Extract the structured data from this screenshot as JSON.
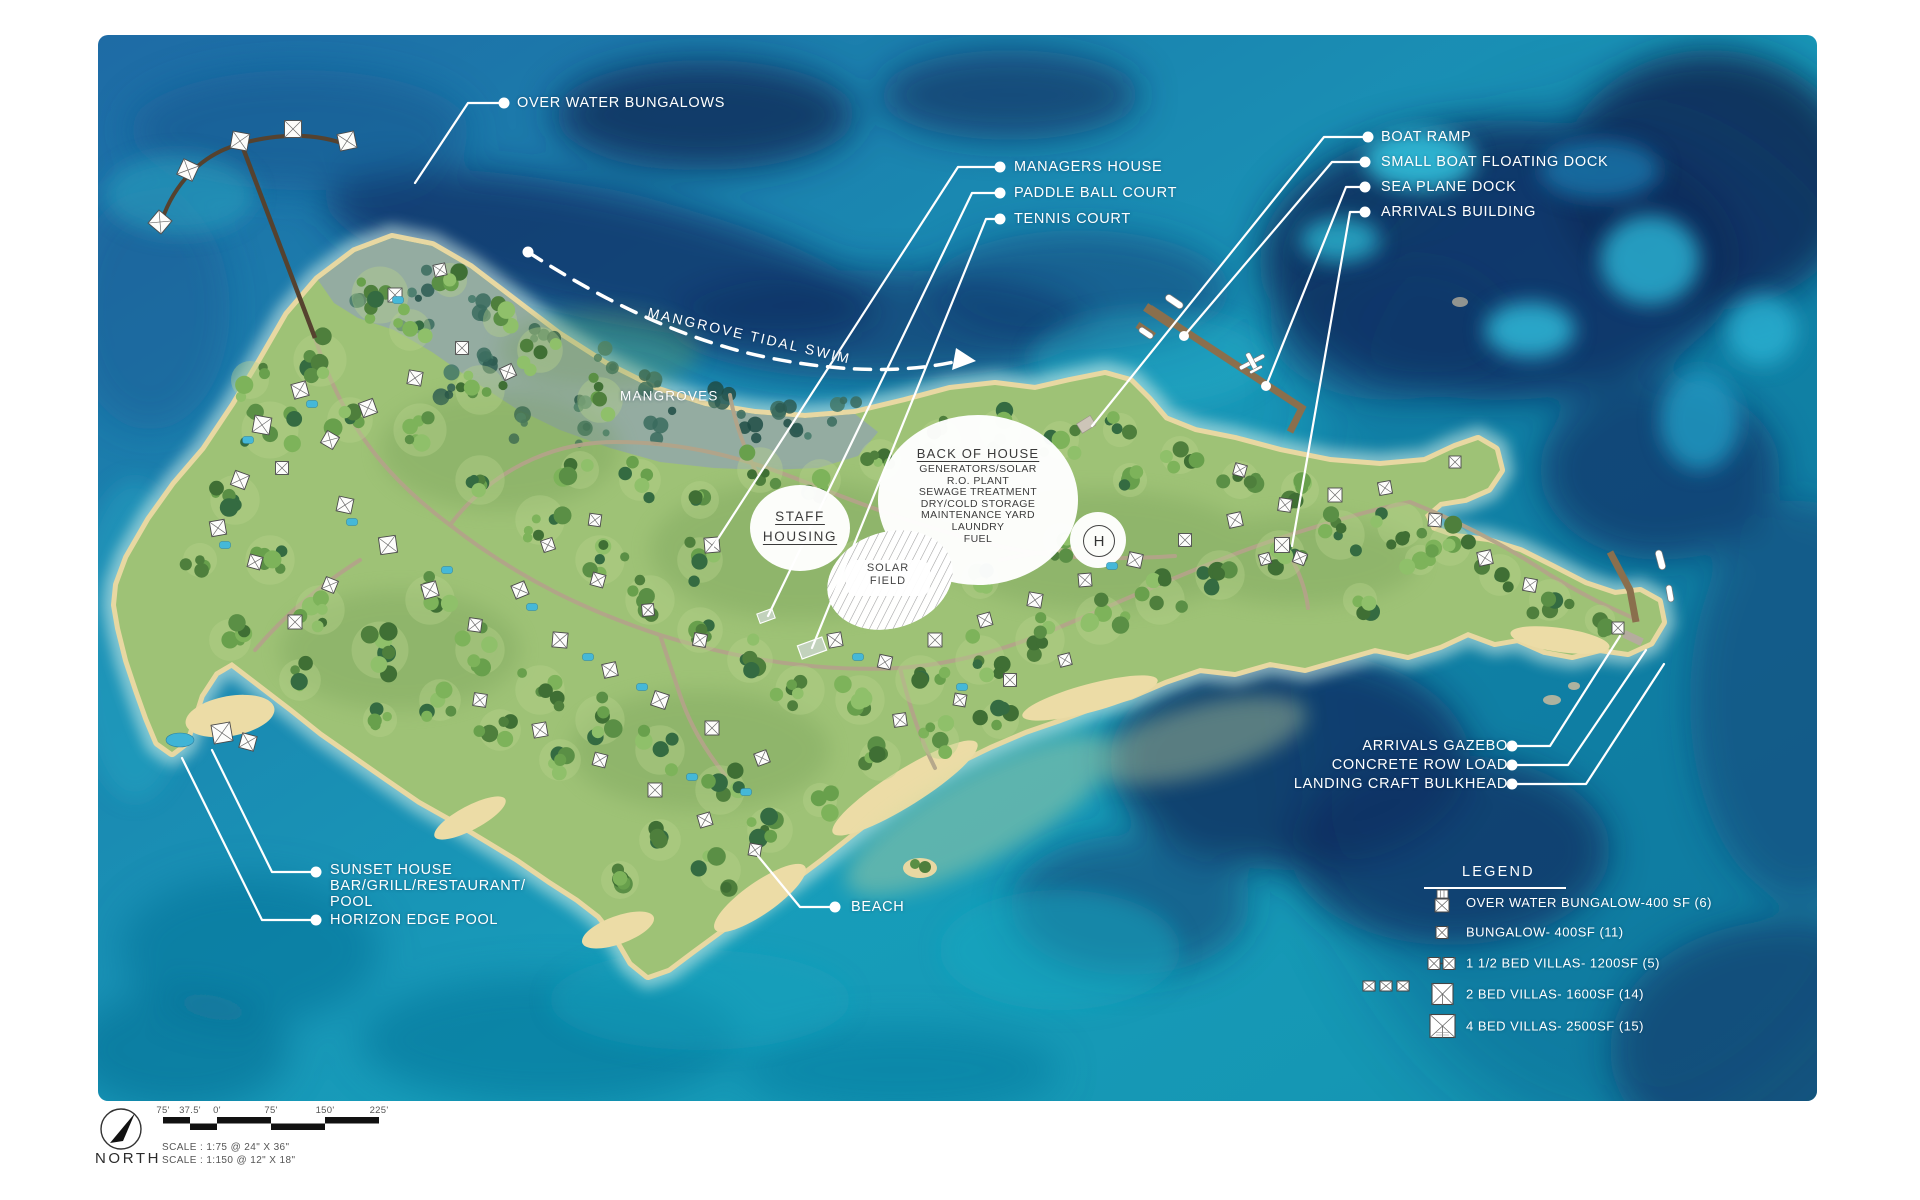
{
  "map": {
    "labels": {
      "over_water_bungalows": "OVER WATER BUNGALOWS",
      "managers_house": "MANAGERS HOUSE",
      "paddle_ball_court": "PADDLE BALL COURT",
      "tennis_court": "TENNIS COURT",
      "boat_ramp": "BOAT RAMP",
      "small_boat_floating_dock": "SMALL BOAT FLOATING DOCK",
      "sea_plane_dock": "SEA PLANE DOCK",
      "arrivals_building": "ARRIVALS BUILDING",
      "arrivals_gazebo": "ARRIVALS GAZEBO",
      "concrete_row_load": "CONCRETE ROW LOAD",
      "landing_craft_bulkhead": "LANDING CRAFT BULKHEAD",
      "sunset_house_line1": "SUNSET HOUSE",
      "sunset_house_line2": "BAR/GRILL/RESTAURANT/",
      "sunset_house_line3": "POOL",
      "horizon_edge_pool": "HORIZON EDGE POOL",
      "beach": "BEACH",
      "mangroves": "MANGROVES",
      "mangrove_tidal_swim": "MANGROVE TIDAL SWIM"
    },
    "staff_housing_line1": "STAFF",
    "staff_housing_line2": "HOUSING",
    "solar_field_line1": "SOLAR",
    "solar_field_line2": "FIELD",
    "helipad": "H",
    "back_of_house": {
      "title": "BACK OF HOUSE",
      "items": [
        "GENERATORS/SOLAR",
        "R.O. PLANT",
        "SEWAGE TREATMENT",
        "DRY/COLD STORAGE",
        "MAINTENANCE YARD",
        "LAUNDRY",
        "FUEL"
      ]
    }
  },
  "legend": {
    "title": "LEGEND",
    "items": [
      {
        "icon": "over-water-bungalow-icon",
        "label": "OVER WATER BUNGALOW-400 SF (6)"
      },
      {
        "icon": "bungalow-icon",
        "label": "BUNGALOW- 400SF (11)"
      },
      {
        "icon": "one-and-half-bed-villa-icon",
        "label": "1 1/2 BED VILLAS- 1200SF (5)"
      },
      {
        "icon": "two-bed-villa-icon",
        "label": "2 BED VILLAS- 1600SF (14)"
      },
      {
        "icon": "four-bed-villa-icon",
        "label": "4 BED VILLAS- 2500SF (15)"
      }
    ]
  },
  "scale": {
    "north_label": "NORTH",
    "ticks": [
      "75'",
      "37.5'",
      "0'",
      "75'",
      "150'",
      "225'"
    ],
    "scale_line1": "SCALE : 1:75   @ 24\" X 36\"",
    "scale_line2": "SCALE : 1:150 @ 12\" X 18\""
  },
  "colors": {
    "water_turquoise": "#189ab8",
    "water_deep_navy": "#0e2a58",
    "island_green": "#9ec276",
    "sand": "#e8d8a2",
    "mangrove": "#93aba3",
    "label_white": "#ffffff"
  }
}
